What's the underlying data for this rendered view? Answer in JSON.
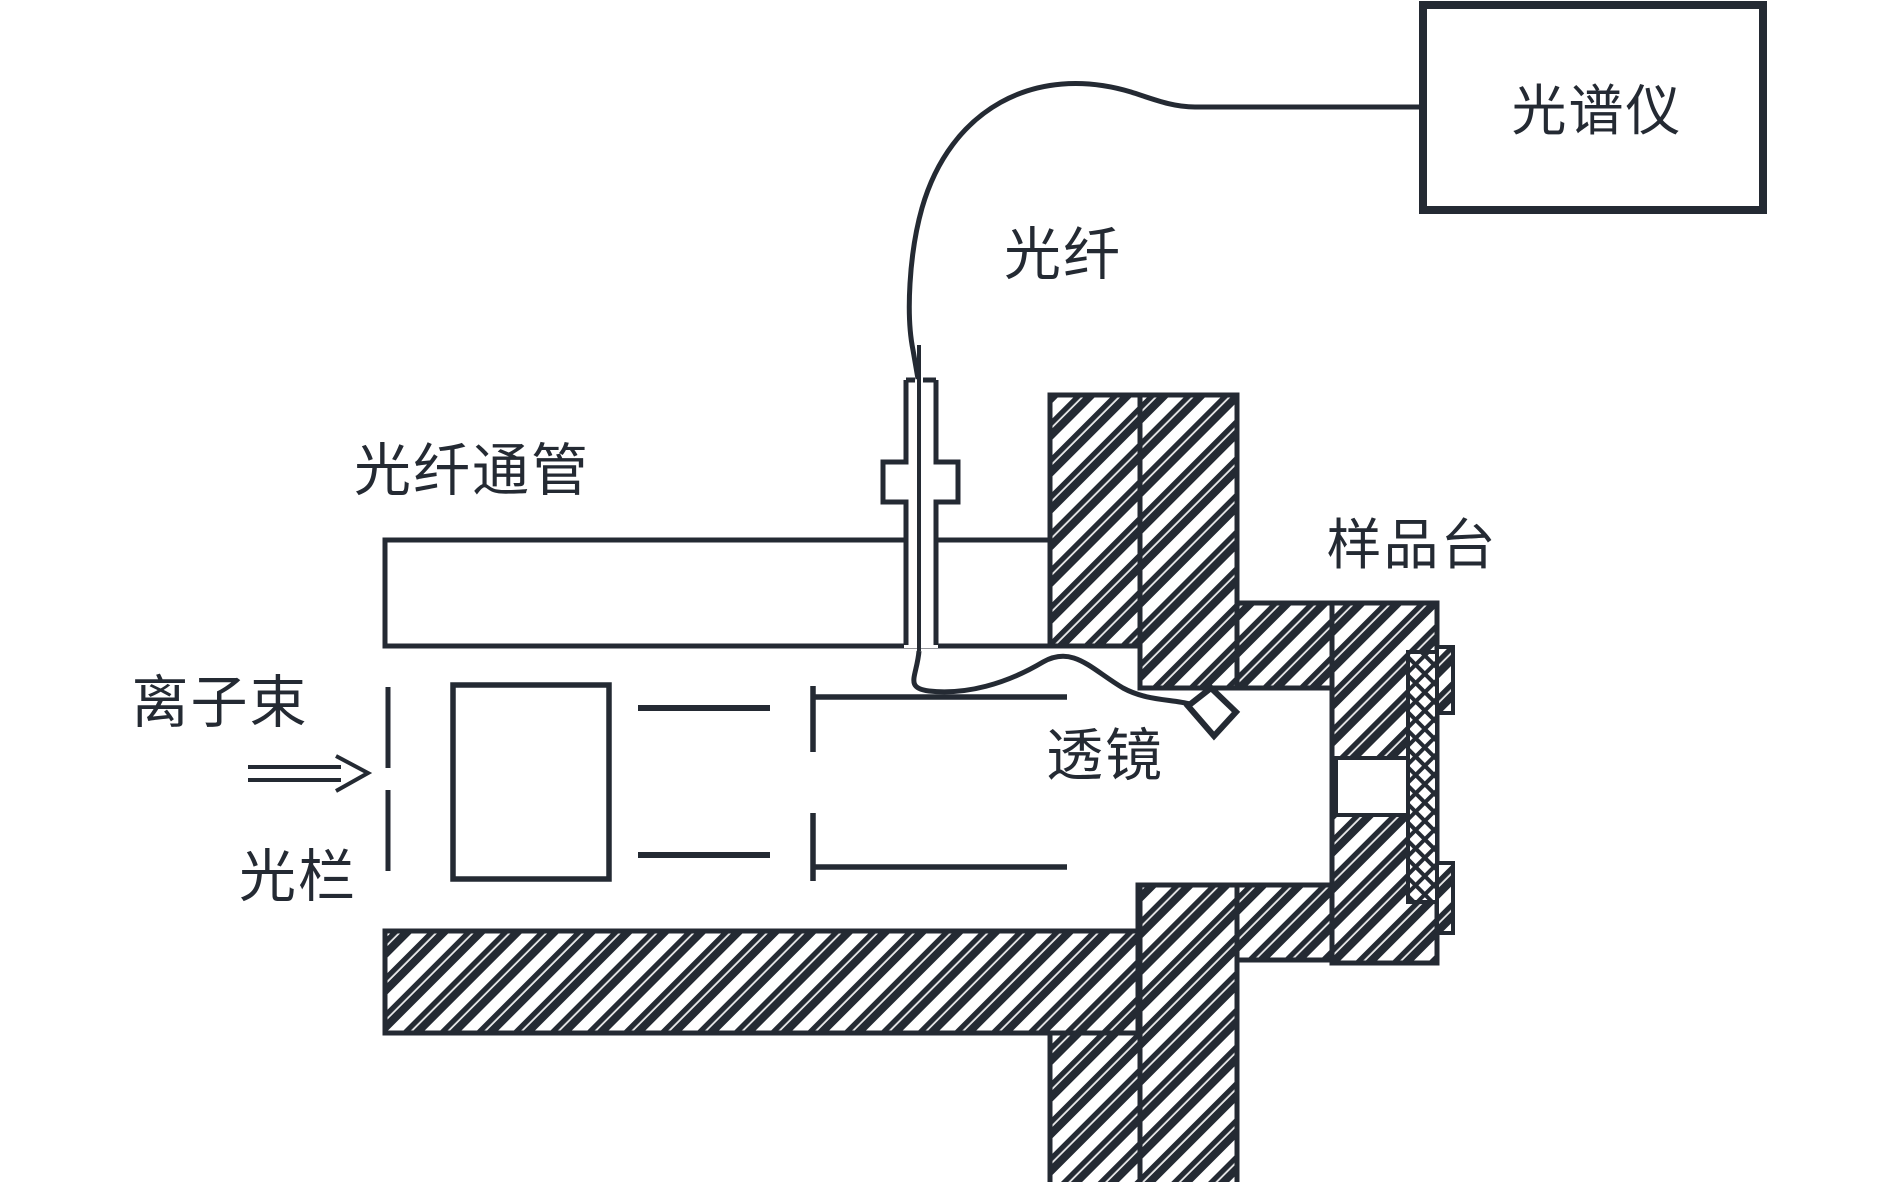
{
  "figure": {
    "type": "optical-spectroscopy-setup-schematic",
    "labels": {
      "spectrometer": "光谱仪",
      "optical_fiber": "光纤",
      "fiber_feedthrough_tube": "光纤通管",
      "sample_stage": "样品台",
      "ion_beam": "离子束",
      "aperture": "光栏",
      "lens": "透镜"
    },
    "colors": {
      "ink": "#242a33",
      "background": "#ffffff"
    }
  }
}
